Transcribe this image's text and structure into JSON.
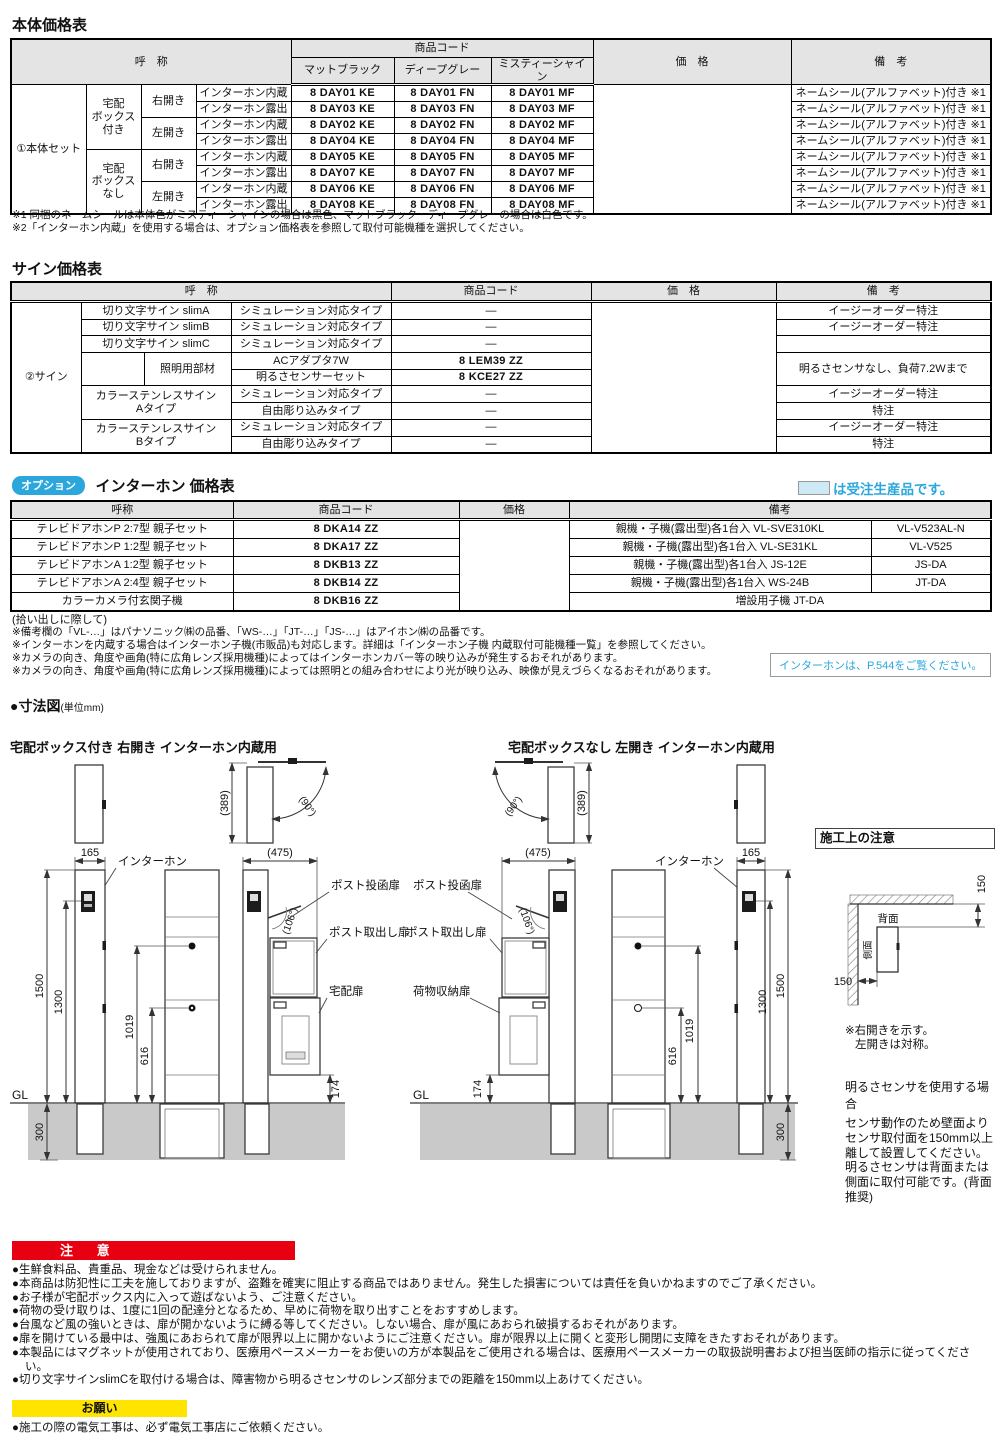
{
  "main_table": {
    "title": "本体価格表",
    "h_name": "呼　称",
    "h_code": "商品コード",
    "h_price": "価　格",
    "h_remarks": "備　考",
    "colors": [
      "マットブラック",
      "ディープグレー",
      "ミスティーシャイン"
    ],
    "group": "①本体セット",
    "box_with": "宅配\nボックス\n付き",
    "box_without": "宅配\nボックス\nなし",
    "right_open": "右開き",
    "left_open": "左開き",
    "remark_all": "ネームシール(アルファベット)付き ※1",
    "rows": [
      {
        "mount": "インターホン内蔵",
        "ke": "8 DAY01 KE",
        "fn": "8 DAY01 FN",
        "mf": "8 DAY01 MF"
      },
      {
        "mount": "インターホン露出",
        "ke": "8 DAY03 KE",
        "fn": "8 DAY03 FN",
        "mf": "8 DAY03 MF"
      },
      {
        "mount": "インターホン内蔵",
        "ke": "8 DAY02 KE",
        "fn": "8 DAY02 FN",
        "mf": "8 DAY02 MF"
      },
      {
        "mount": "インターホン露出",
        "ke": "8 DAY04 KE",
        "fn": "8 DAY04 FN",
        "mf": "8 DAY04 MF"
      },
      {
        "mount": "インターホン内蔵",
        "ke": "8 DAY05 KE",
        "fn": "8 DAY05 FN",
        "mf": "8 DAY05 MF"
      },
      {
        "mount": "インターホン露出",
        "ke": "8 DAY07 KE",
        "fn": "8 DAY07 FN",
        "mf": "8 DAY07 MF"
      },
      {
        "mount": "インターホン内蔵",
        "ke": "8 DAY06 KE",
        "fn": "8 DAY06 FN",
        "mf": "8 DAY06 MF"
      },
      {
        "mount": "インターホン露出",
        "ke": "8 DAY08 KE",
        "fn": "8 DAY08 FN",
        "mf": "8 DAY08 MF"
      }
    ],
    "footnote1": "※1 同梱のネームシールは本体色がミスティーシャインの場合は黒色、マットブラック・ディープグレーの場合は白色です。",
    "footnote2": "※2「インターホン内蔵」を使用する場合は、オプション価格表を参照して取付可能機種を選択してください。"
  },
  "sign_table": {
    "title": "サイン価格表",
    "h_name": "呼　称",
    "h_code": "商品コード",
    "h_price": "価　格",
    "h_remarks": "備　考",
    "group": "②サイン",
    "name_slimA": "切り文字サイン slimA",
    "name_slimB": "切り文字サイン slimB",
    "name_slimC": "切り文字サイン slimC",
    "name_lighting": "照明用部材",
    "name_stainlessA": "カラーステンレスサイン\nAタイプ",
    "name_stainlessB": "カラーステンレスサイン\nBタイプ",
    "rows": [
      {
        "type": "シミュレーション対応タイプ",
        "code": "—",
        "remark": "イージーオーダー特注"
      },
      {
        "type": "シミュレーション対応タイプ",
        "code": "—",
        "remark": "イージーオーダー特注"
      },
      {
        "type": "シミュレーション対応タイプ",
        "code": "—",
        "remark": ""
      },
      {
        "type": "ACアダプタ7W",
        "code": "8 LEM39 ZZ",
        "remark": "明るさセンサなし、負荷7.2Wまで"
      },
      {
        "type": "明るさセンサーセット",
        "code": "8 KCE27 ZZ"
      },
      {
        "type": "シミュレーション対応タイプ",
        "code": "—",
        "remark": "イージーオーダー特注"
      },
      {
        "type": "自由彫り込みタイプ",
        "code": "—",
        "remark": "特注"
      },
      {
        "type": "シミュレーション対応タイプ",
        "code": "—",
        "remark": "イージーオーダー特注"
      },
      {
        "type": "自由彫り込みタイプ",
        "code": "—",
        "remark": "特注"
      }
    ]
  },
  "option_table": {
    "badge": "オプション",
    "title": "インターホン 価格表",
    "legend": "は受注生産品です。",
    "h_name": "呼称",
    "h_code": "商品コード",
    "h_price": "価格",
    "h_remarks": "備考",
    "rows": [
      {
        "name": "テレビドアホンP 2:7型 親子セット",
        "code": "8 DKA14 ZZ",
        "remark_a": "親機・子機(露出型)各1台入 VL-SVE310KL",
        "remark_b": "VL-V523AL-N"
      },
      {
        "name": "テレビドアホンP 1:2型 親子セット",
        "code": "8 DKA17 ZZ",
        "remark_a": "親機・子機(露出型)各1台入 VL-SE31KL",
        "remark_b": "VL-V525"
      },
      {
        "name": "テレビドアホンA 1:2型 親子セット",
        "code": "8 DKB13 ZZ",
        "remark_a": "親機・子機(露出型)各1台入 JS-12E",
        "remark_b": "JS-DA"
      },
      {
        "name": "テレビドアホンA 2:4型 親子セット",
        "code": "8 DKB14 ZZ",
        "remark_a": "親機・子機(露出型)各1台入 WS-24B",
        "remark_b": "JT-DA"
      },
      {
        "name": "カラーカメラ付玄関子機",
        "code": "8 DKB16 ZZ",
        "remark_full": "増設用子機 JT-DA"
      }
    ],
    "pick_title": "(拾い出しに際して)",
    "notes": [
      "※備考欄の「VL-…」はパナソニック㈱の品番、「WS-…」「JT-…」「JS-…」はアイホン㈱の品番です。",
      "※インターホンを内蔵する場合はインターホン子機(市販品)も対応します。詳細は「インターホン子機 内蔵取付可能機種一覧」を参照してください。",
      "※カメラの向き、角度や画角(特に広角レンズ採用機種)によってはインターホンカバー等の映り込みが発生するおそれがあります。",
      "※カメラの向き、角度や画角(特に広角レンズ採用機種)によっては照明との組み合わせにより光が映り込み、映像が見えづらくなるおそれがあります。"
    ],
    "p544": "インターホンは、P.544をご覧ください。"
  },
  "dims": {
    "title": "●寸法図",
    "unit": "(単位mm)",
    "left_subtitle": "宅配ボックス付き 右開き インターホン内蔵用",
    "right_subtitle": "宅配ボックスなし 左開き インターホン内蔵用",
    "labels": {
      "intercom": "インターホン",
      "post_in": "ポスト投函扉",
      "post_out": "ポスト取出し扉",
      "delivery": "宅配扉",
      "luggage": "荷物収納扉",
      "gl": "GL"
    },
    "values": {
      "d165": "165",
      "d475": "(475)",
      "d389": "(389)",
      "d90": "(90°)",
      "d106": "(106°)",
      "d1500": "1500",
      "d1300": "1300",
      "d1019": "1019",
      "d616": "616",
      "d174": "174",
      "d300": "300"
    }
  },
  "install": {
    "title": "施工上の注意",
    "back_label": "背面",
    "side_label": "側面",
    "clearance": "150",
    "note1": "※右開きを示す。",
    "note2": "左開きは対称。",
    "sensor_title": "明るさセンサを使用する場合",
    "sensor_body": "センサ動作のため壁面よりセンサ取付面を150mm以上離して設置してください。明るさセンサは背面または側面に取付可能です。(背面推奨)"
  },
  "caution": {
    "banner": "注 意",
    "items": [
      "●生鮮食料品、貴重品、現金などは受けられません。",
      "●本商品は防犯性に工夫を施しておりますが、盗難を確実に阻止する商品ではありません。発生した損害については責任を負いかねますのでご了承ください。",
      "●お子様が宅配ボックス内に入って遊ばないよう、ご注意ください。",
      "●荷物の受け取りは、1度に1回の配達分となるため、早めに荷物を取り出すことをおすすめします。",
      "●台風など風の強いときは、扉が開かないように縛る等してください。しない場合、扉が風にあおられ破損するおそれがあります。",
      "●扉を開けている最中は、強風にあおられて扉が限界以上に開かないようにご注意ください。扉が限界以上に開くと変形し開閉に支障をきたすおそれがあります。",
      "●本製品にはマグネットが使用されており、医療用ペースメーカーをお使いの方が本製品をご使用される場合は、医療用ペースメーカーの取扱説明書および担当医師の指示に従ってください。",
      "●切り文字サインslimCを取付ける場合は、障害物から明るさセンサのレンズ部分までの距離を150mm以上あけてください。"
    ]
  },
  "request": {
    "banner": "お願い",
    "items": [
      "●施工の際の電気工事は、必ず電気工事店にご依頼ください。"
    ]
  }
}
